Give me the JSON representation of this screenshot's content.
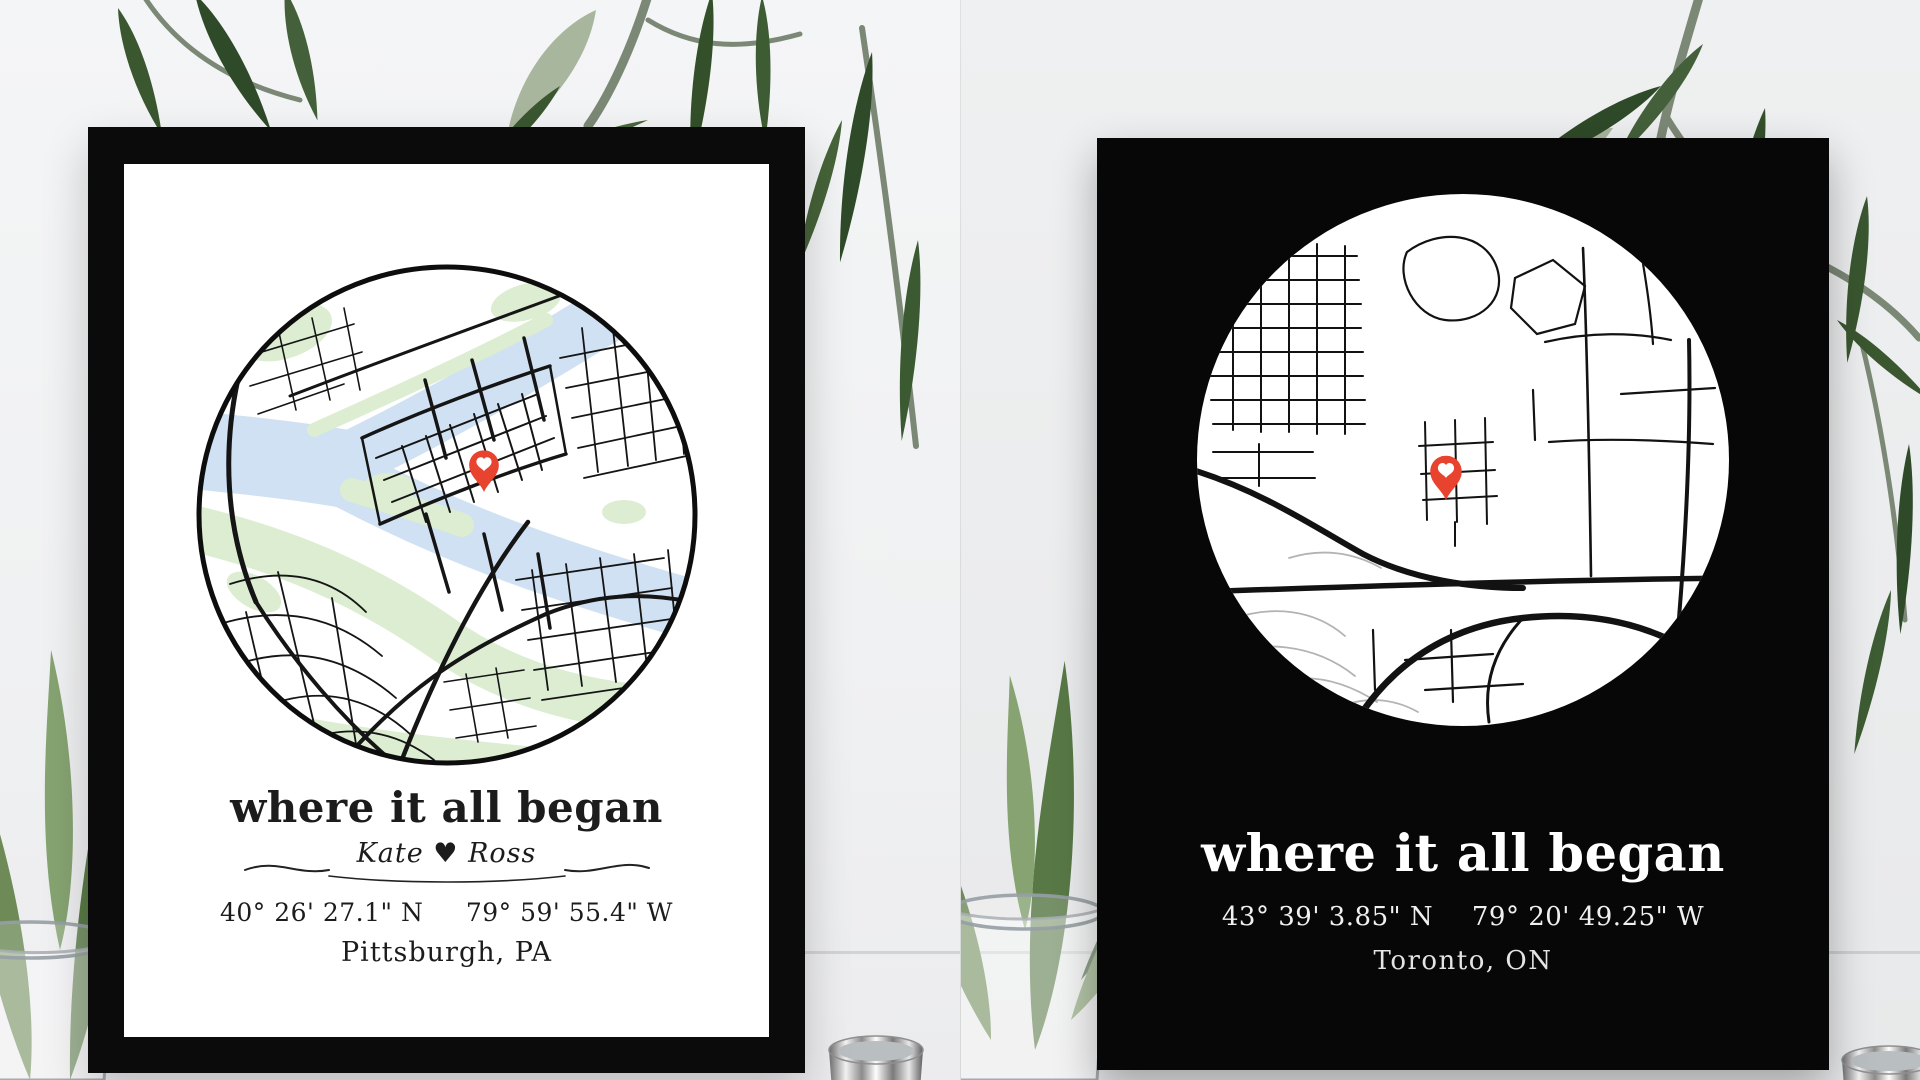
{
  "scene": {
    "background_color": "#f1f2f3",
    "props": [
      "plant-branch",
      "glass-vase-with-leaves",
      "silver-cup"
    ]
  },
  "left_print": {
    "style": "black frame, white matte",
    "frame_color": "#0b0b0b",
    "paper_color": "#ffffff",
    "title": "where it all began",
    "names": "Kate ♥ Ross",
    "latitude": "40° 26' 27.1\" N",
    "longitude": "79° 59' 55.4\" W",
    "location": "Pittsburgh, PA",
    "map": {
      "theme": "light street map in circle",
      "water_color": "#cfe1f2",
      "park_color": "#dcedd2",
      "road_color": "#151515",
      "outline_color": "#0d0d0d",
      "pin_color": "#e8432f"
    }
  },
  "right_print": {
    "style": "black poster, white circle",
    "background_color": "#070707",
    "title": "where it all began",
    "latitude": "43° 39' 3.85\" N",
    "longitude": "79° 20' 49.25\" W",
    "location": "Toronto, ON",
    "map": {
      "theme": "dark poster street map in white circle",
      "circle_color": "#ffffff",
      "road_color": "#121212",
      "secondary_road_color": "#b3b3b3",
      "pin_color": "#e8432f"
    }
  }
}
